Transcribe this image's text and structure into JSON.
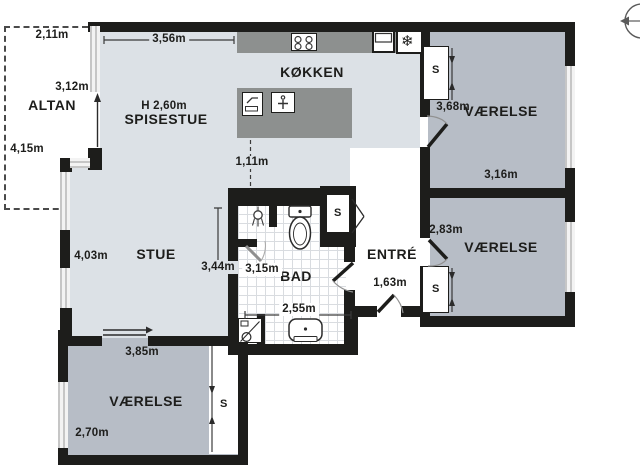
{
  "balcony": {
    "name": "ALTAN",
    "width": "2,11m",
    "door_side": "3,12m",
    "length": "4,15m"
  },
  "kitchen": {
    "name": "KØKKEN",
    "island_clearance": "1,11m"
  },
  "dining": {
    "name": "SPISESTUE",
    "ceiling_height": "H 2,60m",
    "window_width": "3,56m"
  },
  "living": {
    "name": "STUE",
    "width": "4,03m",
    "depth": "3,44m"
  },
  "bath": {
    "name": "BAD",
    "width": "3,15m",
    "depth": "2,55m"
  },
  "entry": {
    "name": "ENTRÉ",
    "door_width": "1,63m"
  },
  "bedroom_top_right": {
    "name": "VÆRELSE",
    "depth": "3,68m",
    "width": "3,16m",
    "closet": "S"
  },
  "bedroom_mid_right": {
    "name": "VÆRELSE",
    "depth": "2,83m",
    "closet": "S"
  },
  "bedroom_bottom_left": {
    "name": "VÆRELSE",
    "width": "3,85m",
    "depth": "2,70m",
    "closet": "S"
  },
  "hall_closet": {
    "label": "S"
  },
  "icons": {
    "snowflake": "❄"
  },
  "colors": {
    "wall": "#1d1d1b",
    "living_floor": "#dce1e6",
    "bedroom_floor": "#b7bdc6",
    "counter": "#8d908f"
  }
}
